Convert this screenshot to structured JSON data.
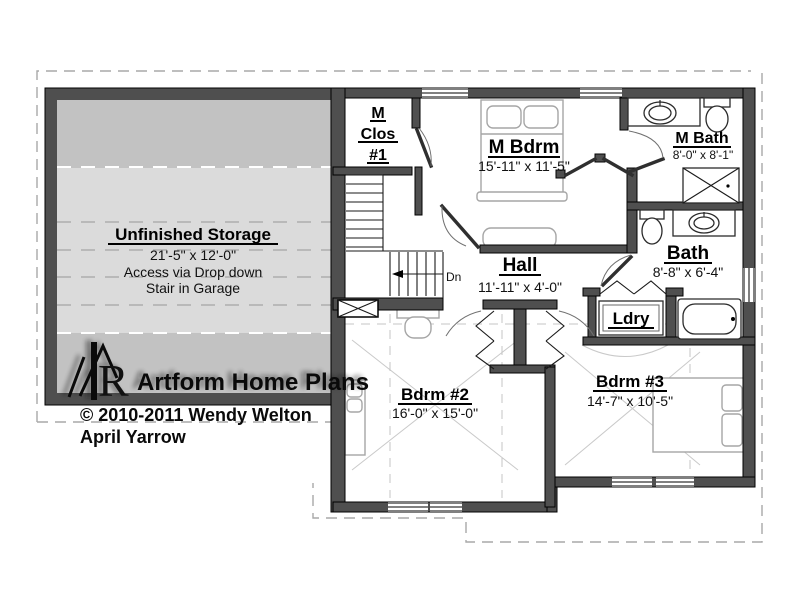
{
  "plan": {
    "rooms": {
      "storage": {
        "name": "Unfinished Storage",
        "dims": "21'-5\" x 12'-0\"",
        "note1": "Access via Drop down",
        "note2": "Stair in Garage"
      },
      "m_clos": {
        "l1": "M",
        "l2": "Clos",
        "l3": "#1"
      },
      "m_bdrm": {
        "name": "M Bdrm",
        "dims": "15'-11\" x 11'-5\""
      },
      "m_bath": {
        "name": "M Bath",
        "dims": "8'-0\" x 8'-1\""
      },
      "hall": {
        "name": "Hall",
        "dims": "11'-11\" x 4'-0\""
      },
      "bath": {
        "name": "Bath",
        "dims": "8'-8\" x 6'-4\""
      },
      "ldry": {
        "name": "Ldry"
      },
      "bdrm2": {
        "name": "Bdrm #2",
        "dims": "16'-0\" x 15'-0\""
      },
      "bdrm3": {
        "name": "Bdrm #3",
        "dims": "14'-7\" x 10'-5\""
      }
    },
    "stairs": {
      "down_label": "Dn"
    },
    "branding": {
      "logo_text": "Artform Home Plans",
      "logo_monogram": "R",
      "copyright": "© 2010-2011 Wendy Welton",
      "client": "April Yarrow"
    },
    "colors": {
      "wall": "#4f4f4f",
      "wall_edge": "#000000",
      "storage_band_dark": "#c2c2c2",
      "storage_band_light": "#dbdbdb",
      "furniture_line": "#a6a6a6",
      "roofline_dash": "#a9a9a9"
    }
  }
}
